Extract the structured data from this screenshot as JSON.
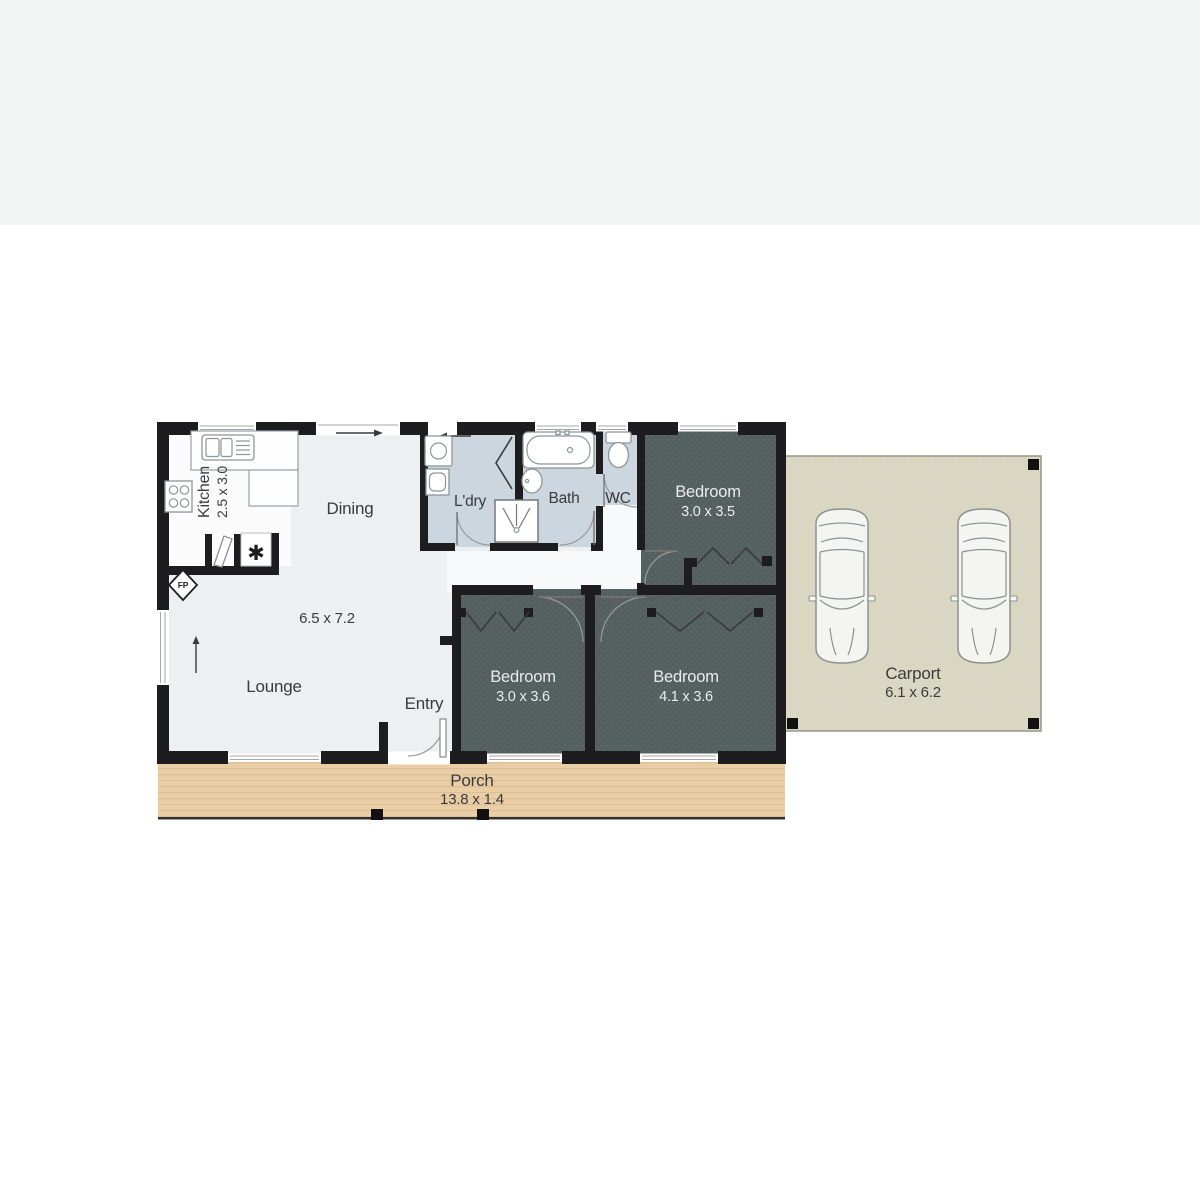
{
  "title": "Floor plan",
  "rooms": {
    "kitchen": {
      "label": "Kitchen",
      "dims": "2.5 x 3.0"
    },
    "dining": {
      "label": "Dining"
    },
    "lounge": {
      "label": "Lounge",
      "dims": "6.5 x 7.2"
    },
    "entry": {
      "label": "Entry"
    },
    "laundry": {
      "label": "L'dry"
    },
    "bath": {
      "label": "Bath"
    },
    "wc": {
      "label": "WC"
    },
    "bedroom1": {
      "label": "Bedroom",
      "dims": "3.0 x 3.5"
    },
    "bedroom2": {
      "label": "Bedroom",
      "dims": "3.0 x 3.6"
    },
    "bedroom3": {
      "label": "Bedroom",
      "dims": "4.1 x 3.6"
    },
    "porch": {
      "label": "Porch",
      "dims": "13.8 x 1.4"
    },
    "carport": {
      "label": "Carport",
      "dims": "6.1 x 6.2"
    }
  },
  "markers": {
    "fireplace": "FP",
    "pantry_symbol": "✱"
  },
  "colors": {
    "wall": "#1d1d1f",
    "living_floor": "#edeff0",
    "kitchen_floor": "#fbfbfb",
    "wet_floor": "#cbd6df",
    "bedroom_floor": "#545f5f",
    "porch": "#e9cea6",
    "carport": "#d9d6c2",
    "top_band": "#f3f4f4"
  }
}
